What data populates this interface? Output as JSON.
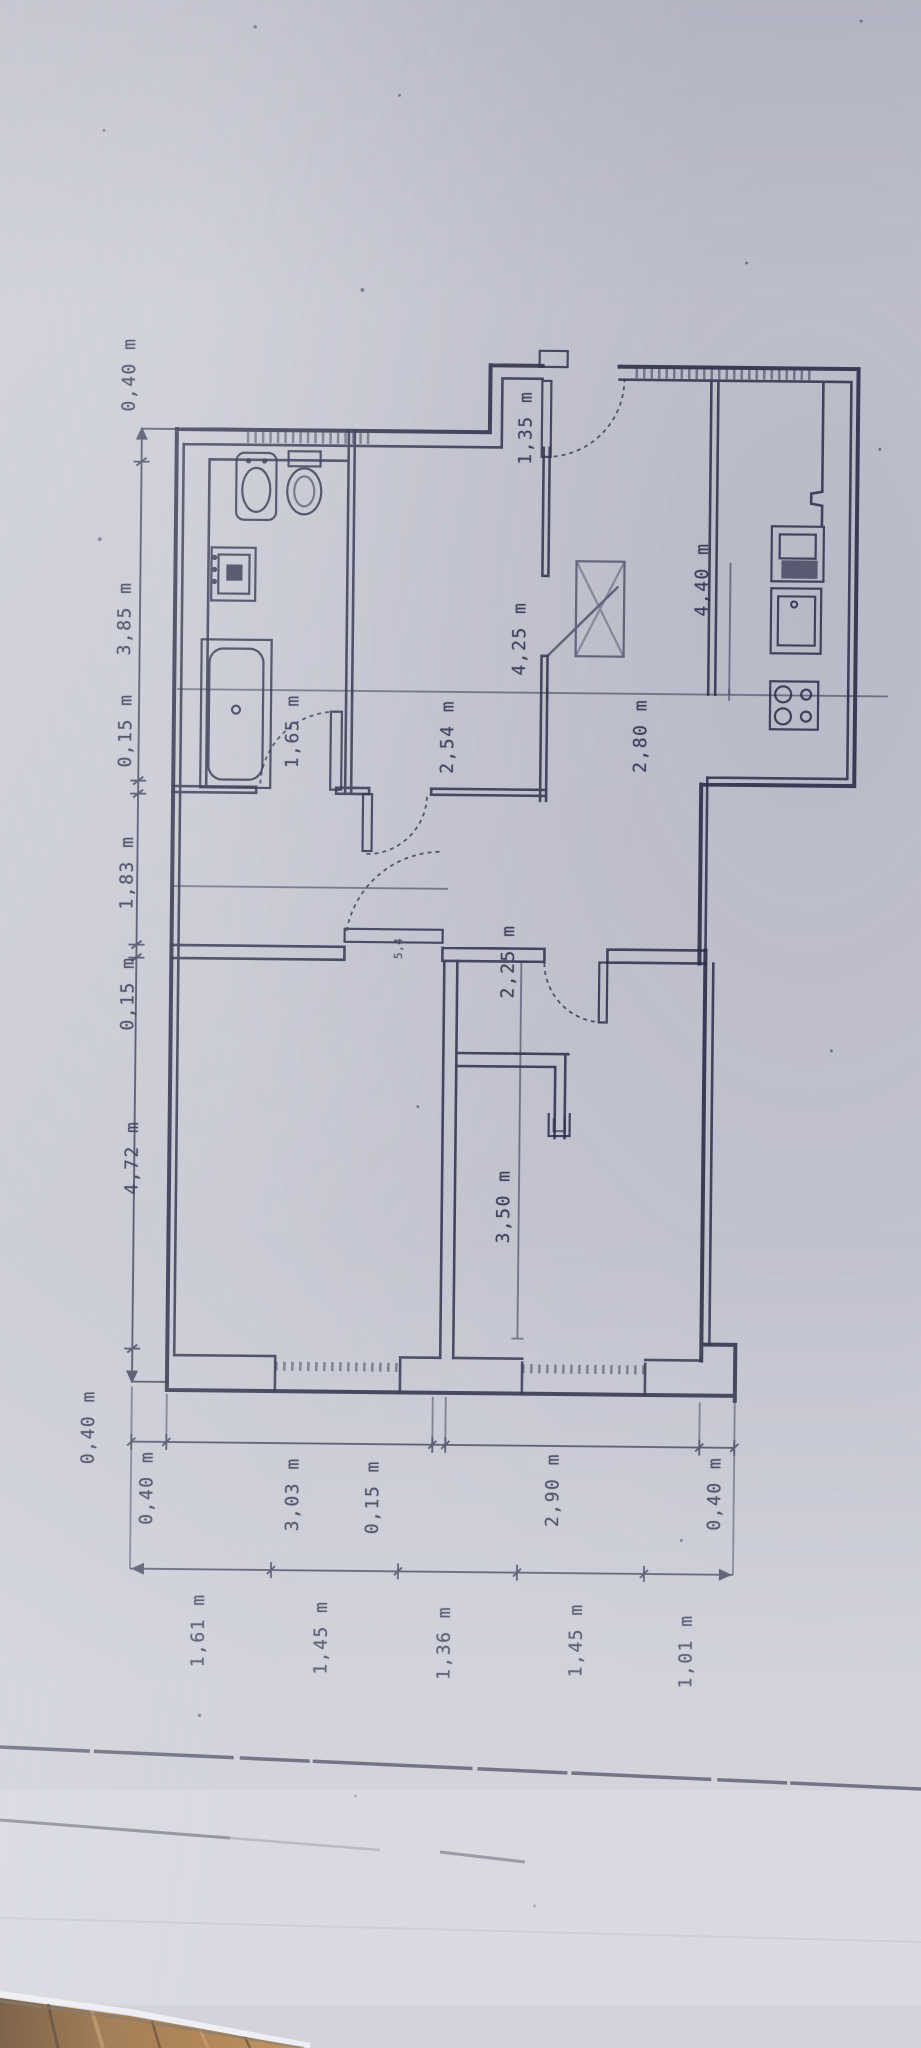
{
  "meta": {
    "description": "Photograph of a hand-drafted apartment floor plan lying on a wooden floor",
    "unit": "m"
  },
  "colors": {
    "paper": "#c7c8d3",
    "ink": "#2c2c48",
    "wood_dark": "#53300f",
    "wood_mid": "#8a5a28",
    "wood_light": "#b57f3f"
  },
  "dimension_chains": {
    "left": {
      "labels": [
        "0,40 m",
        "3,85 m",
        "0,15 m",
        "1,83 m",
        "0,15 m",
        "4,72 m",
        "0,40 m"
      ]
    },
    "bottom_inner": {
      "labels": [
        "0,40 m",
        "3,03 m",
        "0,15 m",
        "2,90 m",
        "0,40 m"
      ]
    },
    "bottom_outer": {
      "labels": [
        "1,61 m",
        "1,45 m",
        "1,36 m",
        "1,45 m",
        "1,01 m"
      ]
    }
  },
  "interior_dimensions": {
    "bathroom_width": "1,65 m",
    "room_width": "2,54 m",
    "hall_width": "2,80 m",
    "room_length": "4,25 m",
    "kitchen_length": "4,40 m",
    "entry_width": "1,35 m",
    "bedroom_upper": "2,25 m",
    "bedroom_length": "3,50 m",
    "door_note": "5,4"
  },
  "fixtures": {
    "bathtub": "bathtub-fixture",
    "sink": "sink-fixture",
    "toilet": "toilet-fixture",
    "washing_machine": "washing-machine-fixture",
    "fridge": "fridge-fixture",
    "kitchen_sink": "kitchen-sink-fixture",
    "stove": "stove-fixture"
  }
}
